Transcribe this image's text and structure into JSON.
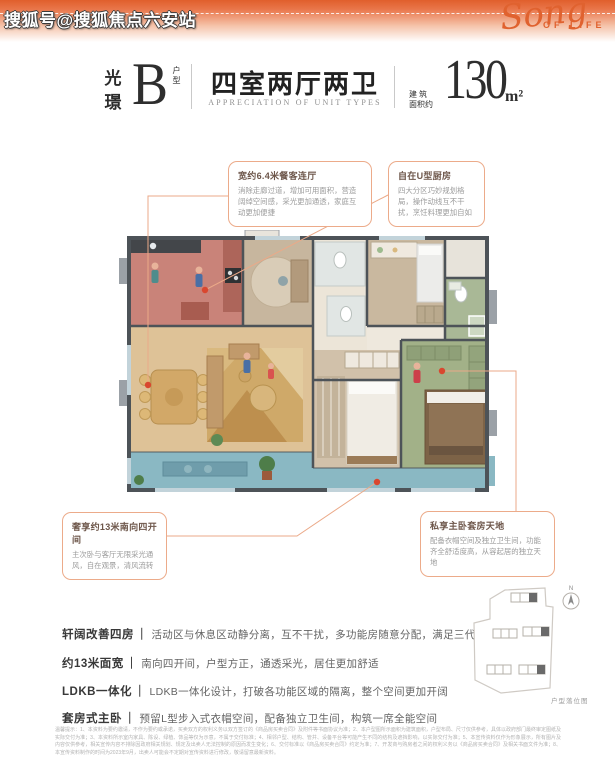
{
  "header": {
    "watermark": "搜狐号@搜狐焦点六安站",
    "logo_script": "Song",
    "logo_caption": "OF LIFE"
  },
  "title": {
    "series_top": "光",
    "series_bottom": "璟",
    "plan_letter": "B",
    "plan_suffix": "户型",
    "headline": "四室两厅两卫",
    "headline_en": "APPRECIATION OF UNIT TYPES",
    "area_label_top": "建筑",
    "area_label_bottom": "面积约",
    "area_value": "130",
    "area_unit": "m²"
  },
  "callouts": [
    {
      "title": "宽约6.4米餐客连厅",
      "body": "消除走廊过道，增加可用面积，营造阔绰空间感，采光更加通透，家庭互动更加便捷"
    },
    {
      "title": "自在U型厨房",
      "body": "四大分区巧妙规划格局，操作动线互不干扰，烹饪料理更加自如"
    },
    {
      "title": "奢享约13米南向四开间",
      "body": "主次卧与客厅无限采光通风，自在观景，清风流转"
    },
    {
      "title": "私享主卧套房天地",
      "body": "配备衣帽空间及独立卫生间，功能齐全舒适度高，从容起居的独立天地"
    }
  ],
  "features": {
    "separator": "｜",
    "items": [
      {
        "label": "轩阔改善四房",
        "desc": "活动区与休息区动静分离，互不干扰，多功能房随意分配，满足三代同堂需求"
      },
      {
        "label": "约13米面宽",
        "desc": "南向四开间，户型方正，通透采光，居住更加舒适"
      },
      {
        "label": "LDKB一体化",
        "desc": "LDKB一体化设计，打破各功能区域的隔离，整个空间更加开阔"
      },
      {
        "label": "套房式主卧",
        "desc": "预留L型步入式衣帽空间，配备独立卫生间，构筑一席全能空间"
      }
    ]
  },
  "siteplan": {
    "compass_letter": "N",
    "caption": "户型落位图"
  },
  "disclaimer": "温馨提示：1、本资料为要约邀请，不作为要约或承诺，买卖双方的权利义务以双方签订的《商品房买卖合同》及附件等书面协议为准；2、本户型图所示面积为建筑面积，户型布局、尺寸仅供参考，具体以政府部门最终审定图纸及实际交付为准；3、本资料所示室内家具、陈设、绿植、饰品等仅为示意，不属于交付标准；4、相邻户型、结构、管井、设备平台等可能产生不同的结构及遮挡影响，以实际交付为准；5、本宣传资料仅作为形象展示，所有图片及内容仅供参考，相关宣传内容不排除因政府相关规划、规定及出卖人无法控制的原因而发生变化；6、交付标准以《商品房买卖合同》约定为准；7、开发商与购房者之间的权利义务以《商品房买卖合同》及相关书面文件为准；8、本宣传资料制作的时间为2023年9月，出卖人可能会不定期对宣传资料进行修改，敬请留意最新资料。"
}
